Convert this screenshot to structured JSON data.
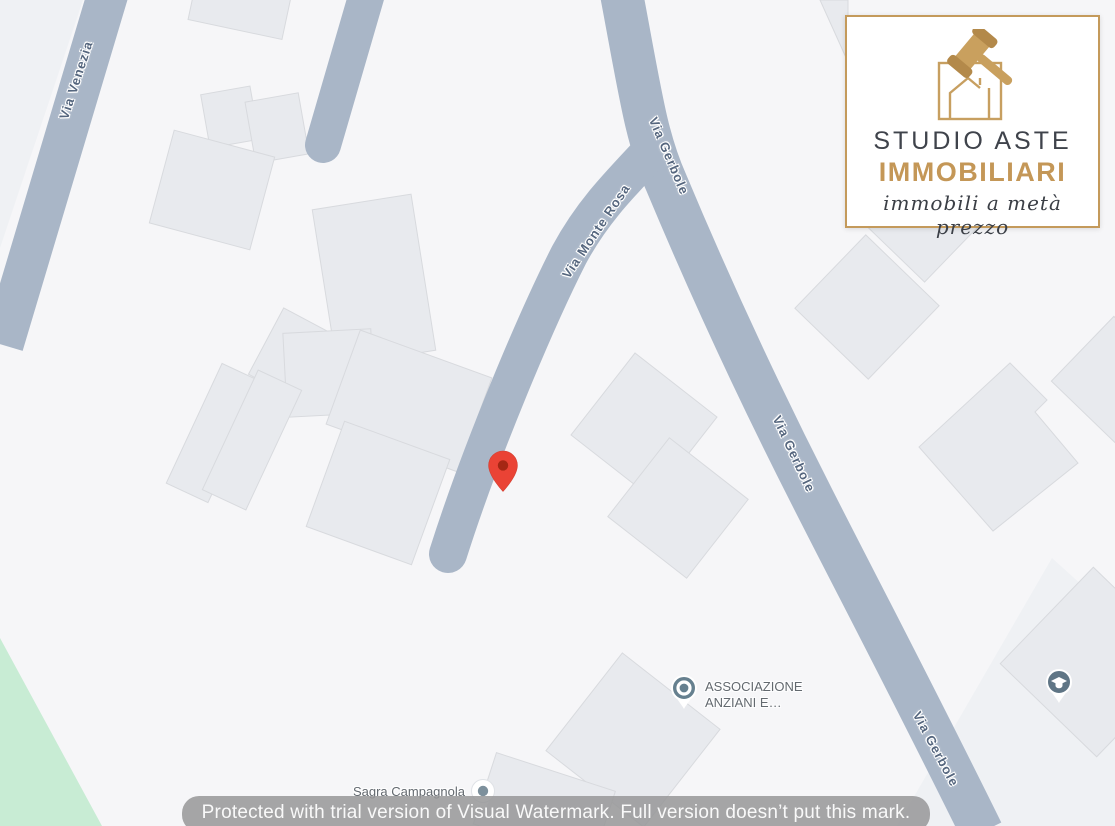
{
  "map": {
    "streets": [
      {
        "id": "via-venezia",
        "label": "Via Venezia"
      },
      {
        "id": "via-monte-rosa",
        "label": "Via Monte Rosa"
      },
      {
        "id": "via-gerbole-top",
        "label": "Via Gerbole"
      },
      {
        "id": "via-gerbole-mid",
        "label": "Via Gerbole"
      },
      {
        "id": "via-gerbole-bottom",
        "label": "Via Gerbole"
      }
    ],
    "pois": {
      "associazione": {
        "label": "ASSOCIAZIONE ANZIANI E…",
        "icon": "generic-poi-pin"
      },
      "sagra": {
        "label": "Sagra Campagnola",
        "icon": "dot-poi-pin"
      },
      "school": {
        "label": "",
        "icon": "graduation-cap-pin"
      }
    },
    "marker": {
      "color": "#ea4335",
      "dot_color": "#a52714"
    },
    "colors": {
      "background": "#f6f6f8",
      "road": "#a9b6c7",
      "building": "#e8eaee",
      "park": "#c8ecd4",
      "poi": "#66808f",
      "street_text": "#55667e"
    }
  },
  "logo": {
    "title_line1": "STUDIO ASTE",
    "title_line2": "IMMOBILIARI",
    "tagline": "immobili a metà prezzo",
    "accent": "#c49757"
  },
  "watermark": {
    "text": "Protected with trial version of Visual Watermark. Full version doesn’t put this mark."
  }
}
